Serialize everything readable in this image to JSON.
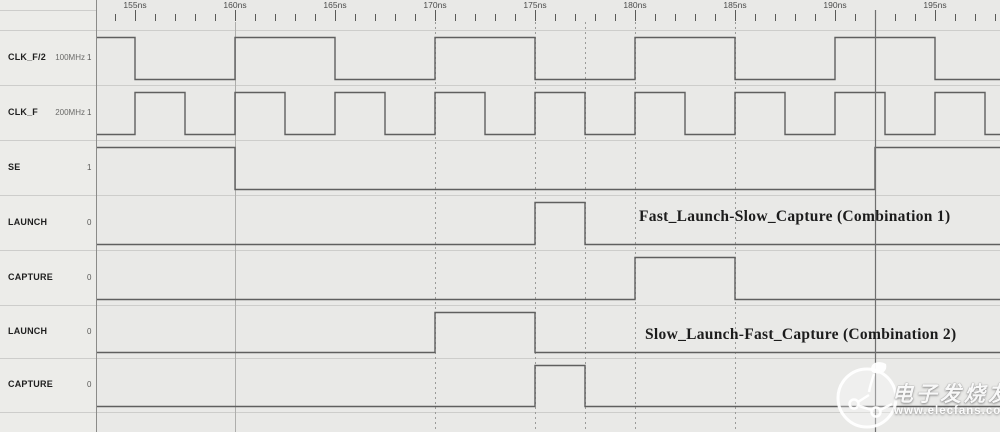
{
  "timeline": {
    "unit": "ns",
    "window_start": 153.1,
    "window_end": 198.25,
    "minor_tick_ns": 1,
    "major_tick_ns": 5,
    "tick_times": [
      155,
      160,
      165,
      170,
      175,
      180,
      185,
      190,
      195
    ],
    "tick_labels": [
      "155ns",
      "160ns",
      "165ns",
      "170ns",
      "175ns",
      "180ns",
      "185ns",
      "190ns",
      "195ns"
    ]
  },
  "signals": [
    {
      "name": "CLK_F/2",
      "annotation": "100MHz",
      "cursor_value": "1",
      "initial_level": 1,
      "edges": [
        155,
        160,
        165,
        170,
        175,
        180,
        185,
        190,
        195
      ]
    },
    {
      "name": "CLK_F",
      "annotation": "200MHz",
      "cursor_value": "1",
      "initial_level": 0,
      "edges": [
        155,
        157.5,
        160,
        162.5,
        165,
        167.5,
        170,
        172.5,
        175,
        177.5,
        180,
        182.5,
        185,
        187.5,
        190,
        192.5,
        195,
        197.5
      ]
    },
    {
      "name": "SE",
      "annotation": "",
      "cursor_value": "1",
      "initial_level": 1,
      "edges": [
        160,
        192
      ]
    },
    {
      "name": "LAUNCH",
      "annotation": "",
      "cursor_value": "0",
      "initial_level": 0,
      "edges": [
        175,
        177.5
      ]
    },
    {
      "name": "CAPTURE",
      "annotation": "",
      "cursor_value": "0",
      "initial_level": 0,
      "edges": [
        180,
        185
      ]
    },
    {
      "name": "LAUNCH",
      "annotation": "",
      "cursor_value": "0",
      "initial_level": 0,
      "edges": [
        170,
        175
      ]
    },
    {
      "name": "CAPTURE",
      "annotation": "",
      "cursor_value": "0",
      "initial_level": 0,
      "edges": [
        175,
        177.5
      ]
    }
  ],
  "reference_lines": [
    {
      "time": 160,
      "style": "solid"
    },
    {
      "time": 170,
      "style": "dashed"
    },
    {
      "time": 175,
      "style": "dashed"
    },
    {
      "time": 177.5,
      "style": "dashed"
    },
    {
      "time": 180,
      "style": "dashed"
    },
    {
      "time": 185,
      "style": "dashed"
    }
  ],
  "cursor": {
    "time": 192
  },
  "annotations": [
    {
      "text": "Fast_Launch-Slow_Capture (Combination 1)"
    },
    {
      "text": "Slow_Launch-Fast_Capture (Combination 2)"
    }
  ],
  "watermark": {
    "brand": "电子发烧友",
    "url": "www.elecfans.com"
  },
  "colors": {
    "background": "#e9e9e7",
    "panel_background": "#ecece9",
    "wave_line": "#5f5f5f",
    "row_border": "#cdcdcb",
    "panel_border": "#8b8b89",
    "ref_solid": "#aeaeac",
    "ref_dashed": "#9b9b99",
    "cursor_line": "#6f6f6f",
    "ruler_text": "#4a4a4a"
  }
}
